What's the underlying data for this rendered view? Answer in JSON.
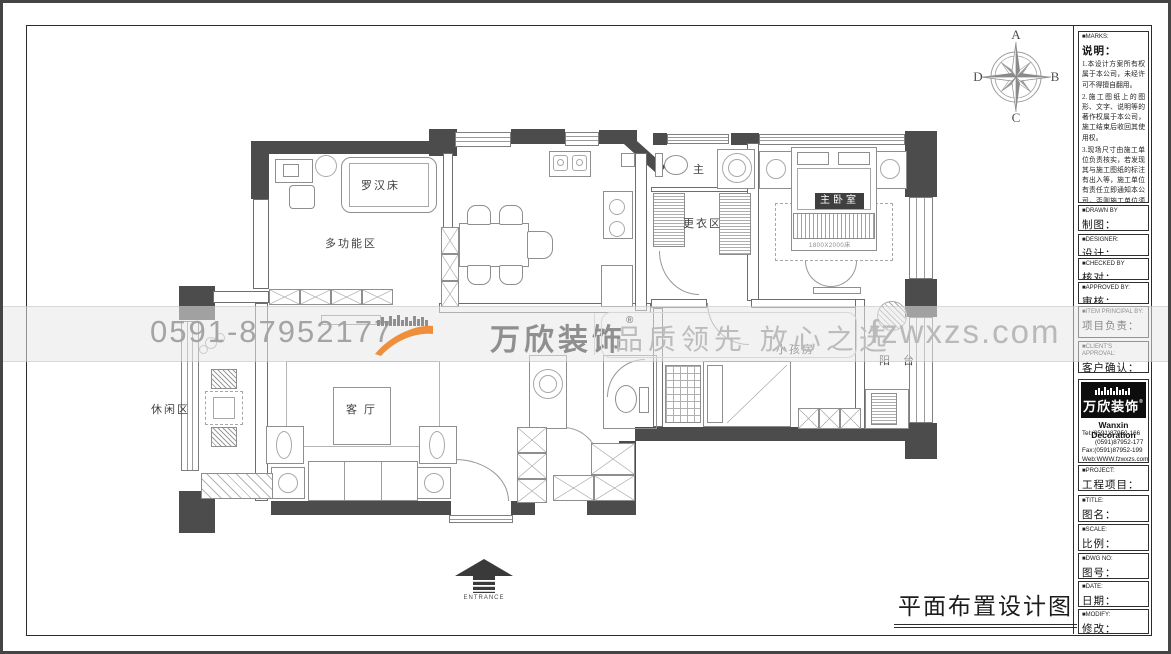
{
  "colors": {
    "accent_orange": "#ef8f3c",
    "wall_gray": "#4c4c4c",
    "watermark_gray": "#b9b9b9"
  },
  "compass": {
    "n": "A",
    "e": "B",
    "s": "C",
    "w": "D"
  },
  "watermark": {
    "phone": "0591-87952177",
    "brand": "万欣装饰",
    "reg": "®",
    "slogan": "品质领先 放心之选",
    "site": "fzwxzs.com"
  },
  "plan": {
    "labels": {
      "luohan_bed": "罗汉床",
      "multi_function": "多功能区",
      "master_bath": "主 卫",
      "dressing": "更衣区",
      "master_bedroom": "主卧室",
      "bed_size": "1800X2000床",
      "kids_room": "小孩房",
      "balcony": "阳 台",
      "leisure": "休闲区",
      "living": "客 厅",
      "entrance": "ENTRANCE"
    }
  },
  "footer": {
    "drawing_title": "平面布置设计图"
  },
  "title_block": {
    "marks": {
      "en": "■MARKS:",
      "zh": "说明：",
      "notes": [
        "1.本设计方案所有权属于本公司，未经许可不得擅自翻用。",
        "2.施工图纸上的图形、文字、说明等的著作权属于本公司，施工结束后收回其使用权。",
        "3.现场尺寸由施工单位负责核实，若发现其与施工图纸的标注有出入等，施工单位有责任立即通知本公司，否则施工单位须承担所有责任。",
        "4.本设计方案是依客户要求设计，经客户签字即视为同意认可，不得随意更改。"
      ]
    },
    "fields": [
      {
        "en": "■DRAWN BY",
        "zh": "制图："
      },
      {
        "en": "■DESIGNER:",
        "zh": "设计："
      },
      {
        "en": "■CHECKED BY",
        "zh": "核对："
      },
      {
        "en": "■APPROVED BY:",
        "zh": "审核："
      },
      {
        "en": "■ITEM PRINCIPAL BY:",
        "zh": "项目负责："
      },
      {
        "en": "■CLIENT'S APPROVAL:",
        "zh": "客户确认："
      },
      {
        "en": "■PROJECT:",
        "zh": "工程项目："
      },
      {
        "en": "■TITLE:",
        "zh": "图名："
      },
      {
        "en": "■SCALE:",
        "zh": "比例："
      },
      {
        "en": "■DWG NO:",
        "zh": "图号："
      },
      {
        "en": "■DATE:",
        "zh": "日期："
      },
      {
        "en": "■MODIFY:",
        "zh": "修改："
      }
    ],
    "company": {
      "name_cn": "万欣装饰",
      "reg": "®",
      "name_en": "Wanxin Decoration",
      "tel1": "Tel:(0591)87952-166",
      "tel2": "(0591)87952-177",
      "fax": "Fax:(0591)87952-199",
      "web": "Web:WWW.fzwxzs.com"
    }
  }
}
